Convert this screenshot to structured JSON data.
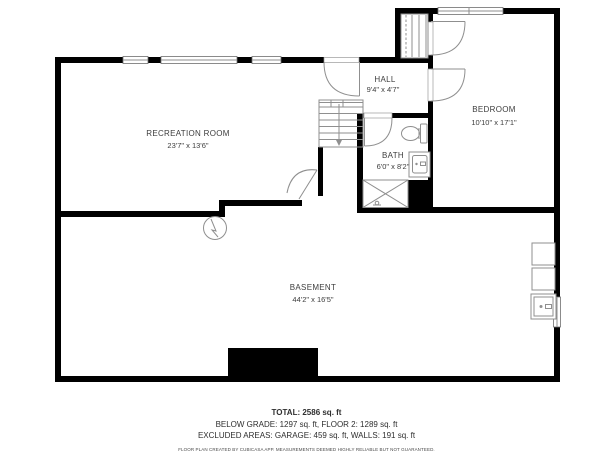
{
  "rooms": {
    "recreation": {
      "name": "RECREATION ROOM",
      "dims": "23'7\" x 13'6\""
    },
    "hall": {
      "name": "HALL",
      "dims": "9'4\" x 4'7\""
    },
    "bedroom": {
      "name": "BEDROOM",
      "dims": "10'10\" x 17'1\""
    },
    "bath": {
      "name": "BATH",
      "dims": "6'0\" x 8'2\""
    },
    "basement": {
      "name": "BASEMENT",
      "dims": "44'2\" x 16'5\""
    }
  },
  "footer": {
    "total": "TOTAL: 2586 sq. ft",
    "line2": "BELOW GRADE: 1297 sq. ft, FLOOR 2: 1289 sq. ft",
    "line3": "EXCLUDED AREAS: GARAGE: 459 sq. ft, WALLS: 191 sq. ft",
    "disclaimer": "FLOOR PLAN CREATED BY CUBICASA APP. MEASUREMENTS DEEMED HIGHLY RELIABLE BUT NOT GUARANTEED."
  },
  "icons": {
    "stairs": "stairs-down-arrow-icon",
    "toilet": "toilet-icon",
    "vanity": "sink-vanity-icon",
    "shower": "shower-icon",
    "pump": "sump-pump-icon",
    "appliances": "laundry-appliance-icons"
  },
  "colors": {
    "wall": "#000000",
    "fixture_line": "#8f8f8f",
    "text": "#3d3d3d",
    "background": "#ffffff"
  }
}
